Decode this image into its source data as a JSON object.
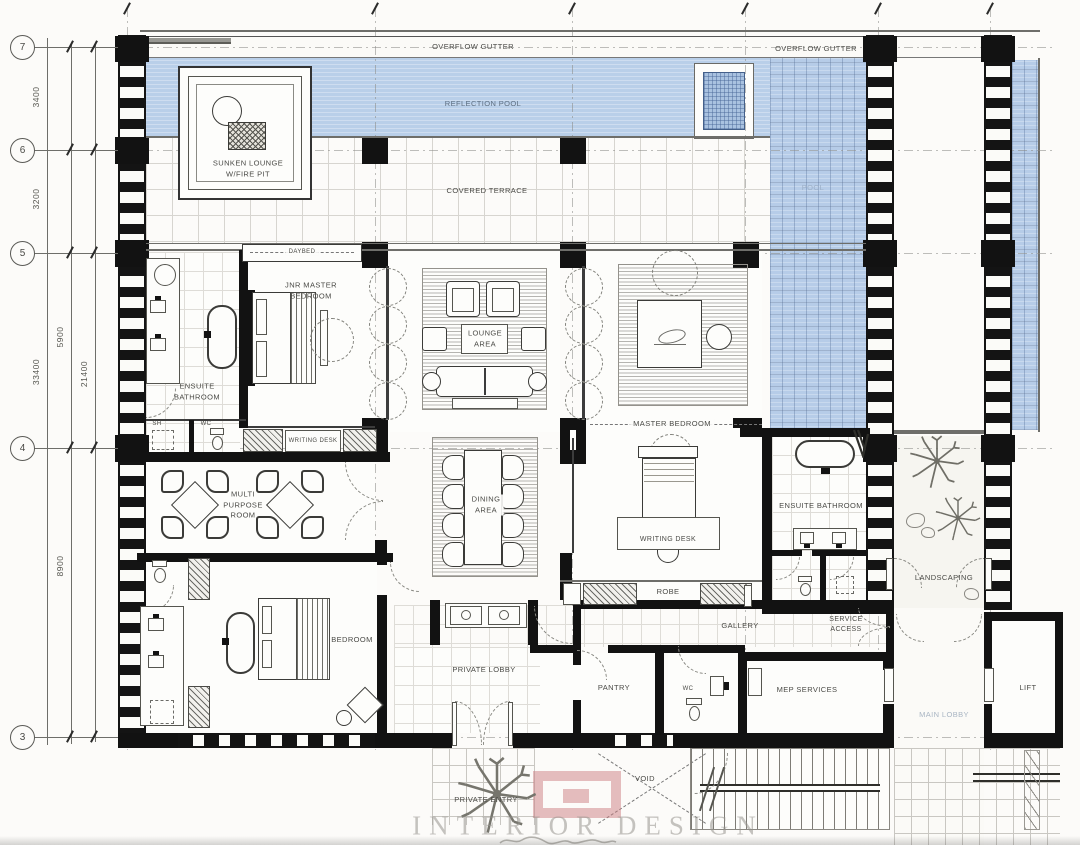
{
  "title": "Villa floor plan",
  "colors": {
    "pool_blue": "#b9cfe9",
    "wall_black": "#121212",
    "label_grey": "#4a4a46",
    "pool_text_grey": "#9cafc7",
    "lobby_text_grey": "#a9b5c3",
    "watermark_grey": "#96948e",
    "logo_red": "#cb7e81"
  },
  "grid": {
    "row_bubbles": [
      {
        "id": "7",
        "y": 47
      },
      {
        "id": "6",
        "y": 150
      },
      {
        "id": "5",
        "y": 253
      },
      {
        "id": "4",
        "y": 448
      },
      {
        "id": "3",
        "y": 737
      }
    ],
    "column_ticks_x": [
      127,
      375,
      572,
      745,
      878,
      990
    ]
  },
  "dimensions": [
    {
      "id": "dim-3400",
      "text": "3400",
      "x": 36,
      "y": 98
    },
    {
      "id": "dim-3200",
      "text": "3200",
      "x": 36,
      "y": 200
    },
    {
      "id": "dim-33400",
      "text": "33400",
      "x": 36,
      "y": 373
    },
    {
      "id": "dim-5900",
      "text": "5900",
      "x": 60,
      "y": 338
    },
    {
      "id": "dim-8900",
      "text": "8900",
      "x": 60,
      "y": 567
    },
    {
      "id": "dim-21400",
      "text": "21400",
      "x": 84,
      "y": 375
    }
  ],
  "labels": [
    {
      "id": "overflow-gutter-left",
      "text": "OVERFLOW GUTTER",
      "x": 473,
      "y": 47,
      "s": 7.5
    },
    {
      "id": "overflow-gutter-right",
      "text": "OVERFLOW GUTTER",
      "x": 816,
      "y": 49,
      "s": 7.5
    },
    {
      "id": "reflection-pool",
      "text": "REFLECTION POOL",
      "x": 483,
      "y": 104,
      "s": 7.5,
      "c": "#5d6e81"
    },
    {
      "id": "sunken-lounge",
      "text": "SUNKEN LOUNGE\nW/FIRE PIT",
      "x": 248,
      "y": 169,
      "s": 7.5
    },
    {
      "id": "covered-terrace",
      "text": "COVERED TERRACE",
      "x": 487,
      "y": 191,
      "s": 7.5
    },
    {
      "id": "pool",
      "text": "POOL",
      "x": 813,
      "y": 188,
      "s": 7.5,
      "c": "#9cafc7"
    },
    {
      "id": "daybed",
      "text": "DAYBED",
      "x": 302,
      "y": 252,
      "s": 6,
      "bg": 1
    },
    {
      "id": "jnr-master-bedroom",
      "text": "JNR MASTER\nBEDROOM",
      "x": 311,
      "y": 291,
      "s": 7.5
    },
    {
      "id": "ensuite-bathroom-left",
      "text": "ENSUITE\nBATHROOM",
      "x": 197,
      "y": 392,
      "s": 7.5
    },
    {
      "id": "sh",
      "text": "SH",
      "x": 157,
      "y": 424,
      "s": 6
    },
    {
      "id": "wc-left",
      "text": "WC",
      "x": 206,
      "y": 424,
      "s": 6
    },
    {
      "id": "writing-desk-jnr",
      "text": "WRITING DESK",
      "x": 313,
      "y": 441,
      "s": 6
    },
    {
      "id": "lounge-area",
      "text": "LOUNGE\nAREA",
      "x": 485,
      "y": 339,
      "s": 7.5
    },
    {
      "id": "master-bedroom",
      "text": "MASTER BEDROOM",
      "x": 672,
      "y": 424,
      "s": 7.5,
      "bg": 1
    },
    {
      "id": "multi-purpose-room",
      "text": "MULTI\nPURPOSE\nROOM",
      "x": 243,
      "y": 505,
      "s": 7.5
    },
    {
      "id": "dining-area",
      "text": "DINING\nAREA",
      "x": 486,
      "y": 505,
      "s": 7.5,
      "bg": 1
    },
    {
      "id": "writing-desk-master",
      "text": "WRITING DESK",
      "x": 668,
      "y": 540,
      "s": 7
    },
    {
      "id": "robe",
      "text": "ROBE",
      "x": 668,
      "y": 592,
      "s": 7.5
    },
    {
      "id": "ensuite-bathroom-right",
      "text": "ENSUITE BATHROOM",
      "x": 821,
      "y": 506,
      "s": 7.5
    },
    {
      "id": "landscaping",
      "text": "LANDSCAPING",
      "x": 944,
      "y": 578,
      "s": 7.5
    },
    {
      "id": "bedroom",
      "text": "BEDROOM",
      "x": 352,
      "y": 640,
      "s": 7.5
    },
    {
      "id": "private-lobby",
      "text": "PRIVATE LOBBY",
      "x": 484,
      "y": 670,
      "s": 7.5
    },
    {
      "id": "gallery",
      "text": "GALLERY",
      "x": 740,
      "y": 626,
      "s": 7.5
    },
    {
      "id": "service-access",
      "text": "SERVICE\nACCESS",
      "x": 846,
      "y": 625,
      "s": 7
    },
    {
      "id": "pantry",
      "text": "PANTRY",
      "x": 614,
      "y": 688,
      "s": 7.5
    },
    {
      "id": "wc-bottom",
      "text": "WC",
      "x": 688,
      "y": 689,
      "s": 6
    },
    {
      "id": "mep-services",
      "text": "MEP SERVICES",
      "x": 807,
      "y": 690,
      "s": 7.5
    },
    {
      "id": "main-lobby",
      "text": "MAIN LOBBY",
      "x": 944,
      "y": 715,
      "s": 7.5,
      "c": "#a9b5c3"
    },
    {
      "id": "lift",
      "text": "LIFT",
      "x": 1028,
      "y": 688,
      "s": 7.5
    },
    {
      "id": "private-entry",
      "text": "PRIVATE ENTRY",
      "x": 486,
      "y": 800,
      "s": 7.5
    },
    {
      "id": "void",
      "text": "VOID",
      "x": 645,
      "y": 779,
      "s": 7.5
    }
  ],
  "watermark": {
    "text": "INTERIOR DESIGN"
  }
}
